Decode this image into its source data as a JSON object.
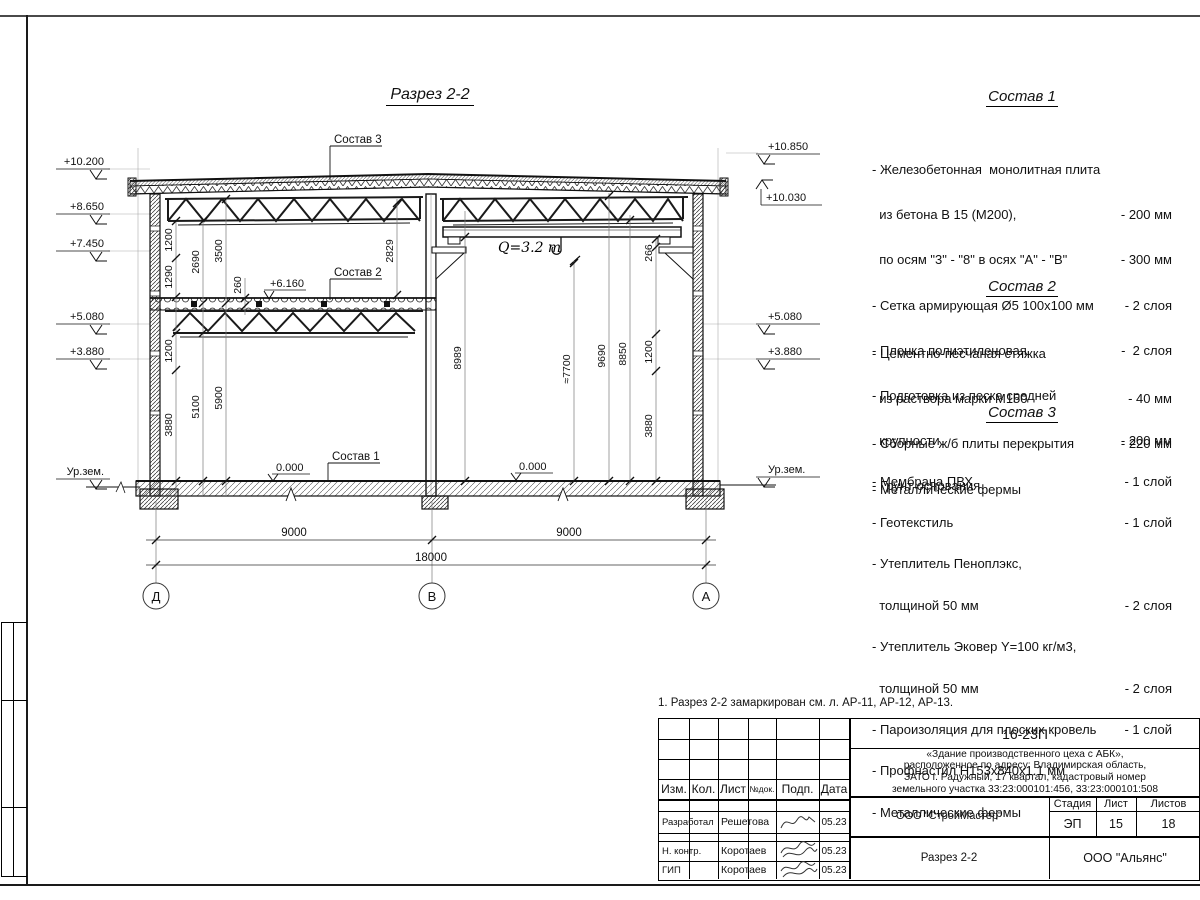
{
  "drawing": {
    "title": "Разрез 2-2",
    "labels": {
      "sostav1": "Состав 1",
      "sostav2": "Состав 2",
      "sostav3": "Состав 3",
      "crane": "Q=3.2 т",
      "elev6160": "+6.160",
      "zero_left": "0.000",
      "zero_right": "0.000",
      "ground_left": "Ур.зем.",
      "ground_right": "Ур.зем."
    },
    "elev_left": [
      "+10.200",
      "+8.650",
      "+7.450",
      "+5.080",
      "+3.880"
    ],
    "elev_right": [
      "+10.850",
      "+10.030",
      "+5.080",
      "+3.880"
    ],
    "dims": {
      "left_chain": [
        "1200",
        "1290",
        "1200",
        "3880",
        "2690",
        "5100",
        "3500",
        "5900",
        "260",
        "2829"
      ],
      "right_chain": [
        "266",
        "8989",
        "≈7700",
        "9690",
        "8850",
        "1200",
        "3880"
      ],
      "bottom": [
        "9000",
        "9000",
        "18000"
      ]
    },
    "axes": [
      "Д",
      "В",
      "А"
    ]
  },
  "specs": [
    {
      "title": "Состав 1",
      "rows": [
        {
          "t": "- Железобетонная  монолитная плита",
          "v": ""
        },
        {
          "t": "  из бетона В 15 (М200),",
          "v": "- 200 мм"
        },
        {
          "t": "  по осям \"3\" - \"8\" в осях \"А\" - \"В\"",
          "v": "- 300 мм"
        },
        {
          "t": "- Сетка армирующая Ø5 100х100 мм",
          "v": "- 2 слоя"
        },
        {
          "t": "- Пленка полиэтиленовая",
          "v": "-  2 слоя"
        },
        {
          "t": "- Подготовка из песка средней",
          "v": ""
        },
        {
          "t": "  крупности",
          "v": "- 200 мм"
        },
        {
          "t": "- Грунт основания",
          "v": ""
        }
      ]
    },
    {
      "title": "Состав 2",
      "rows": [
        {
          "t": "- Цементно-песчаная стяжка",
          "v": ""
        },
        {
          "t": "  из раствора марки М150",
          "v": "- 40 мм"
        },
        {
          "t": "- Сборные ж/б плиты перекрытия",
          "v": "- 220 мм"
        },
        {
          "t": "- Металлические фермы",
          "v": ""
        }
      ]
    },
    {
      "title": "Состав 3",
      "rows": [
        {
          "t": "- Мембрана ПВХ",
          "v": "- 1 слой"
        },
        {
          "t": "- Геотекстиль",
          "v": "- 1 слой"
        },
        {
          "t": "- Утеплитель Пеноплэкс,",
          "v": ""
        },
        {
          "t": "  толщиной 50 мм",
          "v": "- 2 слоя"
        },
        {
          "t": "- Утеплитель Эковер Y=100 кг/м3,",
          "v": ""
        },
        {
          "t": "  толщиной 50 мм",
          "v": "- 2 слоя"
        },
        {
          "t": "- Пароизоляция для плоских кровель",
          "v": "- 1 слой"
        },
        {
          "t": "- Профнастил Н153х840х1.1 мм",
          "v": ""
        },
        {
          "t": "- Металлические фермы",
          "v": ""
        }
      ]
    }
  ],
  "note": "1. Разрез 2-2 замаркирован см. л. АР-11, АР-12, АР-13.",
  "titleblock": {
    "code": "16-23П",
    "description_lines": [
      "«Здание производственного цеха с АБК»,",
      "расположенное по адресу: Владимирская область,",
      "ЗАТО г. Радужный, 17 квартал, кадастровый номер",
      "земельного участка 33:23:000101:456, 33:23:000101:508"
    ],
    "cols": {
      "izm": "Изм.",
      "kol": "Кол.",
      "list": "Лист",
      "ndoc": "№док.",
      "podp": "Подп.",
      "data": "Дата"
    },
    "rows": [
      {
        "role": "Разработал",
        "name": "Решетова",
        "date": "05.23"
      },
      {
        "role": "Н. контр.",
        "name": "Коротаев",
        "date": "05.23"
      },
      {
        "role": "ГИП",
        "name": "Коротаев",
        "date": "05.23"
      }
    ],
    "org": "ООО \"СтройМастер\"",
    "stage_label": "Стадия",
    "sheet_label": "Лист",
    "sheets_label": "Листов",
    "stage": "ЭП",
    "sheet": "15",
    "sheets": "18",
    "doc_title": "Разрез 2-2",
    "customer": "ООО \"Альянс\""
  }
}
